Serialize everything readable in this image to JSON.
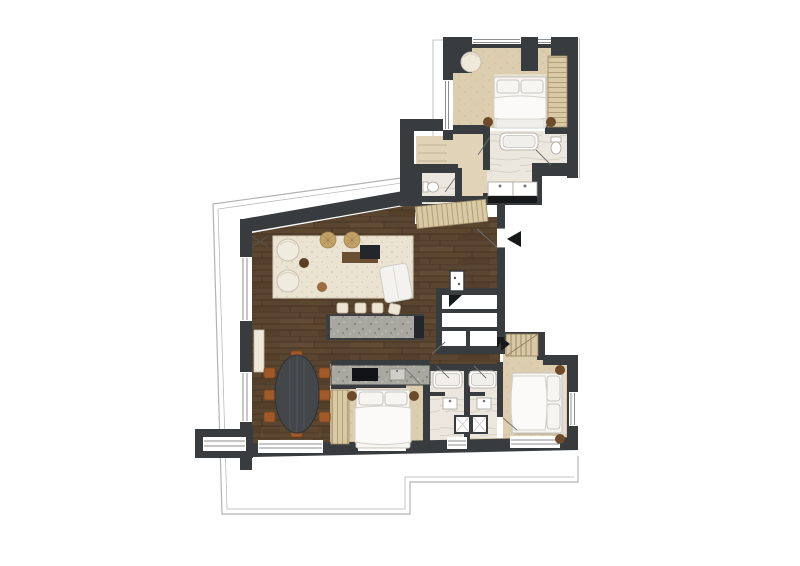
{
  "image_type": "architectural floor plan, top-down furnished apartment plan, no text labels",
  "colors": {
    "wall": "#383c3e",
    "wood_base": "#5a4530",
    "floor_beige": "#e0d3b8",
    "carpet_base": "#dccdae",
    "marble_base": "#ebe7de",
    "granite_base": "#a8a8a0",
    "rug_base": "#eae3d1",
    "wardrobe_base": "#d9c9a4",
    "furniture_white": "#f6f5f2",
    "nightstand": "#6d4a2a",
    "chair_rust": "#a05a28",
    "table_dark": "#44474a",
    "pouf_tan": "#c4a36a",
    "entry_black": "#17181a",
    "terrace_line": "#b3b3b3",
    "window_line": "#8e8e8e",
    "swing_line": "#6f6f6f",
    "exterior": "#ffffff"
  },
  "entry": {
    "marker": "solid triangle arrow pointing left at apartment entry door on right side"
  },
  "rooms": [
    {
      "id": "bedroom-top",
      "floor": "beige carpet",
      "furniture": [
        "double bed with white duvet",
        "2 round nightstands",
        "round armchair",
        "wardrobe with shelves"
      ]
    },
    {
      "id": "ensuite-bathroom-top",
      "floor": "marble",
      "furniture": [
        "bathtub",
        "toilet",
        "double sink vanity with dark counter"
      ]
    },
    {
      "id": "wc",
      "floor": "marble",
      "furniture": [
        "toilet"
      ]
    },
    {
      "id": "hallway-upper",
      "floor": "beige",
      "furniture": [
        "built-in wardrobe band"
      ]
    },
    {
      "id": "living-room",
      "floor": "dark wood planks",
      "furniture": [
        "area rug",
        "2 round lounge chairs",
        "2 woven poufs",
        "coffee table set",
        "white sofa",
        "side tables",
        "sideboard"
      ]
    },
    {
      "id": "kitchen",
      "floor": "dark wood planks",
      "furniture": [
        "granite island with 4 bar stools",
        "counter with cooktop and sink"
      ]
    },
    {
      "id": "dining-area",
      "floor": "dark wood planks",
      "furniture": [
        "oval dark table",
        "8 rust-brown chairs"
      ]
    },
    {
      "id": "entry-hall",
      "floor": "dark wood planks",
      "furniture": [
        "storage closets",
        "technical shaft"
      ]
    },
    {
      "id": "bedroom-left",
      "floor": "beige carpet",
      "furniture": [
        "double bed",
        "2 round nightstands",
        "wardrobe"
      ]
    },
    {
      "id": "bathroom-a",
      "floor": "marble",
      "furniture": [
        "bathtub",
        "sink",
        "shower stall"
      ]
    },
    {
      "id": "bathroom-b",
      "floor": "marble",
      "furniture": [
        "bathtub",
        "sink",
        "shower stall"
      ]
    },
    {
      "id": "bedroom-right",
      "floor": "beige carpet",
      "furniture": [
        "double bed",
        "2 round nightstands",
        "staircase"
      ]
    },
    {
      "id": "terrace",
      "floor": "outline only",
      "furniture": []
    }
  ]
}
